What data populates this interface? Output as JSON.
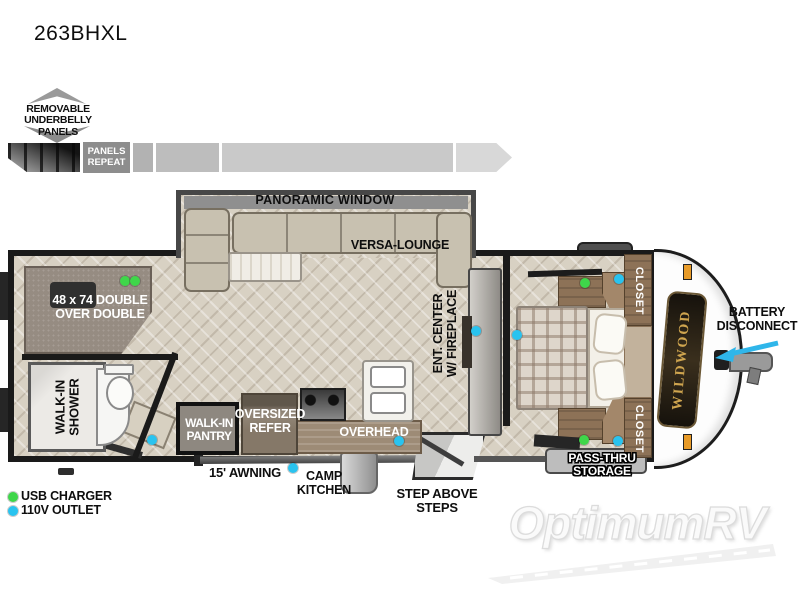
{
  "title": "263BHXL",
  "underbelly": {
    "callout": "REMOVABLE\nUNDERBELLY\nPANELS",
    "repeat": "PANELS\nREPEAT"
  },
  "plan": {
    "panoramic_window": "PANORAMIC WINDOW",
    "versa_lounge": "VERSA-LOUNGE",
    "bunk": "48 x 74 DOUBLE\nOVER DOUBLE",
    "shower": "WALK-IN\nSHOWER",
    "pantry": "WALK-IN\nPANTRY",
    "refer": "OVERSIZED\nREFER",
    "overhead": "OVERHEAD",
    "ent_center": "ENT. CENTER\nW/ FIREPLACE",
    "closet_top": "CLOSET",
    "closet_bottom": "CLOSET",
    "awning": "15' AWNING",
    "camp_kitchen": "CAMP\nKITCHEN",
    "steps": "STEP ABOVE STEPS",
    "storage": "PASS-THRU\nSTORAGE",
    "battery": "BATTERY\nDISCONNECT",
    "brand": "WILDWOOD"
  },
  "legend": {
    "usb": {
      "label": "USB CHARGER",
      "color": "#3fd64a"
    },
    "outlet": {
      "label": "110V OUTLET",
      "color": "#29c3ef"
    }
  },
  "accents": {
    "arrow_blue": "#2fb6ea"
  },
  "watermark": "OptimumRV"
}
